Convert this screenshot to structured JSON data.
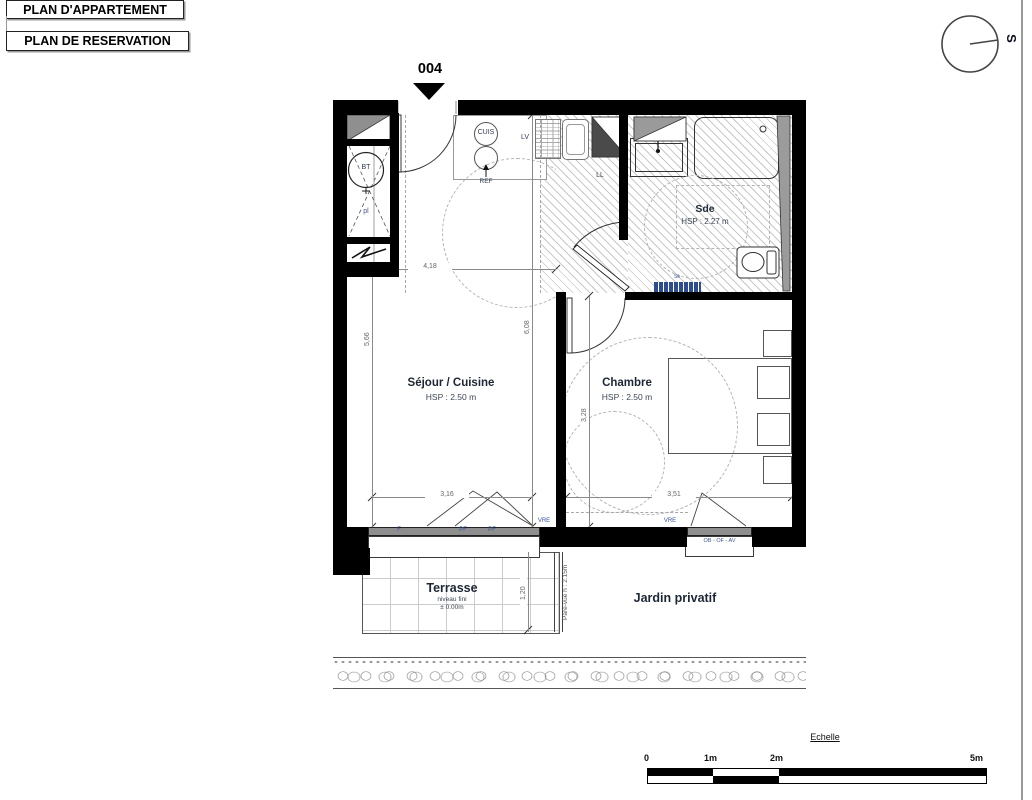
{
  "header": {
    "title1": "PLAN D'APPARTEMENT",
    "title2": "PLAN DE RESERVATION"
  },
  "plan": {
    "unit": "004",
    "compass": "S",
    "rooms": {
      "sde": {
        "name": "Sde",
        "hsp": "HSP : 2.27 m"
      },
      "sejour": {
        "name": "Séjour / Cuisine",
        "hsp": "HSP : 2.50 m"
      },
      "chambre": {
        "name": "Chambre",
        "hsp": "HSP : 2.50 m"
      },
      "terrasse": {
        "name": "Terrasse",
        "niveau_line1": "niveau fini",
        "niveau_line2": "± 0.00m"
      },
      "jardin": {
        "name": "Jardin privatif"
      }
    },
    "equipment": {
      "bt": "BT",
      "pl": "pl",
      "cuis": "CUIS",
      "ref": "REF",
      "lv": "LV",
      "ll": "LL",
      "seche_serviette": "Sè"
    },
    "openings": {
      "f": "F",
      "pf1": "PF",
      "pf2": "PF",
      "vre_sejour": "VRE",
      "vre_chambre": "VRE",
      "volet": "OB - OF - AV",
      "pare_vue": "Pare-vue h : 2.15m"
    },
    "dims": {
      "d418": "4,18",
      "d566": "5,66",
      "d608": "6,08",
      "d316": "3,16",
      "d351": "3,51",
      "d328": "3,28",
      "d120": "1,20"
    }
  },
  "scale_bar": {
    "title": "Echelle",
    "t0": "0",
    "t1": "1m",
    "t2": "2m",
    "t5": "5m"
  },
  "colors": {
    "wall": "#000000",
    "hatch_line": "#c9c9c9",
    "label_navy": "#1c2735",
    "dim_gray": "#666666",
    "blue_label": "#3b5598",
    "rail_blue": "#2e4d8f"
  }
}
